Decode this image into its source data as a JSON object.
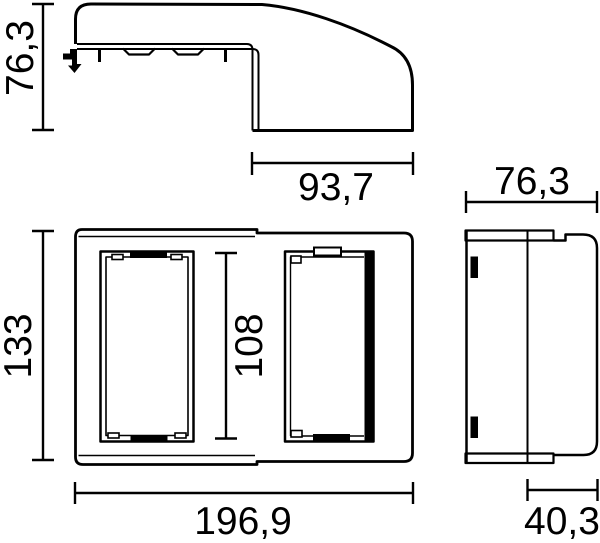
{
  "drawing": {
    "kind": "technical dimension drawing, three views of an enclosure",
    "colors": {
      "line": "#000000",
      "background": "#ffffff"
    },
    "dims": {
      "profile_height": "76,3",
      "profile_front_depth": "93,7",
      "front_height": "133",
      "front_opening_height": "108",
      "front_width": "196,9",
      "side_depth": "76,3",
      "side_base_depth": "40,3"
    }
  }
}
